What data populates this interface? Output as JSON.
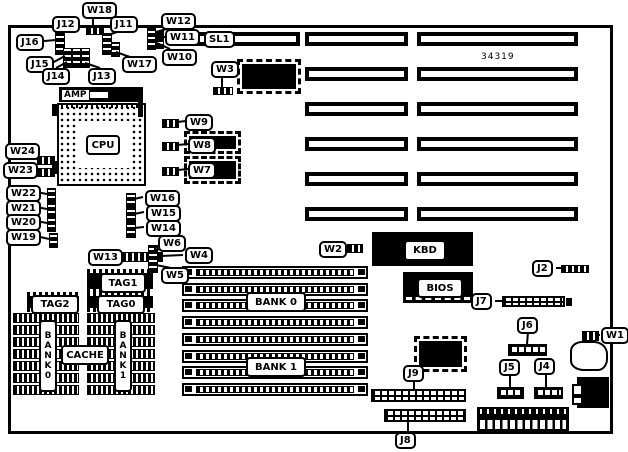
{
  "board": {
    "part_number": "34319"
  },
  "sockets": {
    "cpu": "CPU",
    "cpu_socket_brand": "AMP",
    "slot1": "SL1",
    "kbd": "KBD",
    "bios": "BIOS",
    "tag1": "TAG1",
    "tag2": "TAG2",
    "tag0": "TAG0",
    "cache": "CACHE",
    "cache_bank0": "BANK0",
    "cache_bank1": "BANK1",
    "simm_bank0": "BANK 0",
    "simm_bank1": "BANK 1"
  },
  "callouts": [
    {
      "id": "W18",
      "text": "W18"
    },
    {
      "id": "J12",
      "text": "J12"
    },
    {
      "id": "J11",
      "text": "J11"
    },
    {
      "id": "J16",
      "text": "J16"
    },
    {
      "id": "J15",
      "text": "J15"
    },
    {
      "id": "J14",
      "text": "J14"
    },
    {
      "id": "J13",
      "text": "J13"
    },
    {
      "id": "W17",
      "text": "W17"
    },
    {
      "id": "W12",
      "text": "W12"
    },
    {
      "id": "W11",
      "text": "W11"
    },
    {
      "id": "W10",
      "text": "W10"
    },
    {
      "id": "W3",
      "text": "W3"
    },
    {
      "id": "W9",
      "text": "W9"
    },
    {
      "id": "W8",
      "text": "W8"
    },
    {
      "id": "W7",
      "text": "W7"
    },
    {
      "id": "W24",
      "text": "W24"
    },
    {
      "id": "W23",
      "text": "W23"
    },
    {
      "id": "W22",
      "text": "W22"
    },
    {
      "id": "W21",
      "text": "W21"
    },
    {
      "id": "W20",
      "text": "W20"
    },
    {
      "id": "W19",
      "text": "W19"
    },
    {
      "id": "W16",
      "text": "W16"
    },
    {
      "id": "W15",
      "text": "W15"
    },
    {
      "id": "W14",
      "text": "W14"
    },
    {
      "id": "W6",
      "text": "W6"
    },
    {
      "id": "W13",
      "text": "W13"
    },
    {
      "id": "W4",
      "text": "W4"
    },
    {
      "id": "W5",
      "text": "W5"
    },
    {
      "id": "W2",
      "text": "W2"
    },
    {
      "id": "J7",
      "text": "J7"
    },
    {
      "id": "J2",
      "text": "J2"
    },
    {
      "id": "J6",
      "text": "J6"
    },
    {
      "id": "W1",
      "text": "W1"
    },
    {
      "id": "J9",
      "text": "J9"
    },
    {
      "id": "J8",
      "text": "J8"
    },
    {
      "id": "J5",
      "text": "J5"
    },
    {
      "id": "J4",
      "text": "J4"
    }
  ]
}
